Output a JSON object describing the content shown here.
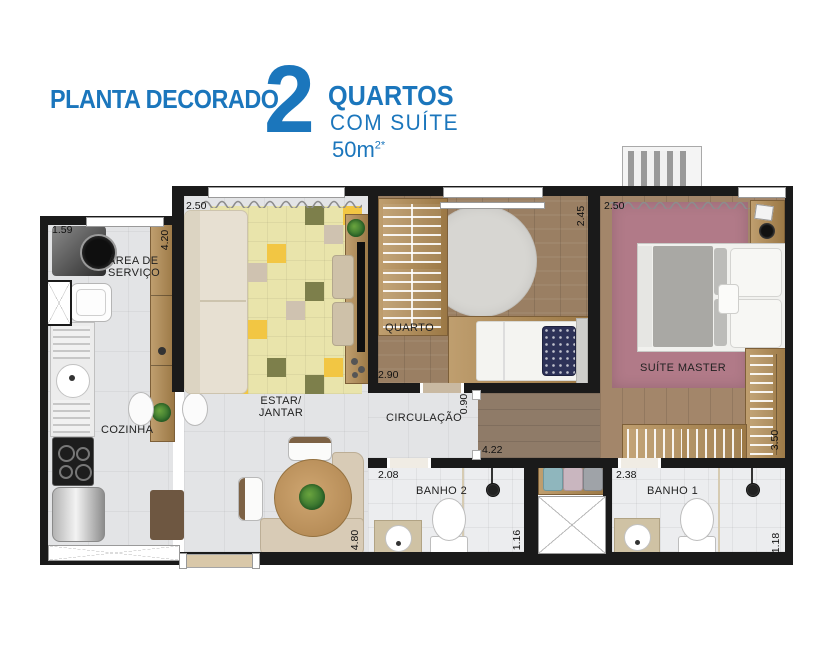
{
  "header": {
    "kicker": "PLANTA DECORADO",
    "number": "2",
    "line1": "QUARTOS",
    "line2": "COM SUÍTE",
    "area_value": "50m",
    "area_sup": "2*"
  },
  "rooms": {
    "servico": "ÁREA DE\nSERVIÇO",
    "cozinha": "COZINHA",
    "estar": "ESTAR/\nJANTAR",
    "quarto": "QUARTO",
    "circulacao": "CIRCULAÇÃO",
    "suite": "SUÍTE MASTER",
    "banho2": "BANHO 2",
    "banho1": "BANHO 1"
  },
  "dimensions": {
    "servico_width": "1.59",
    "servico_height": "4.20",
    "living_width": "2.50",
    "living_height": "4.80",
    "quarto_width": "2.90",
    "quarto_height": "2.45",
    "suite_width": "2.50",
    "suite_closet_height": "3.50",
    "circulacao_width": "0.90",
    "corridor_length": "4.22",
    "banho2_width": "2.08",
    "banho2_height": "1.16",
    "banho1_width": "2.38",
    "banho1_height": "1.18"
  },
  "colors": {
    "brand_blue": "#1b76bc",
    "wall_black": "#1a1a1a",
    "wood_floor": "#9a7f63",
    "suite_rug": "#b17a88",
    "living_rug": "#e9e4ab",
    "accent_yellow": "#f2c643",
    "accent_olive": "#7d7f4b"
  }
}
